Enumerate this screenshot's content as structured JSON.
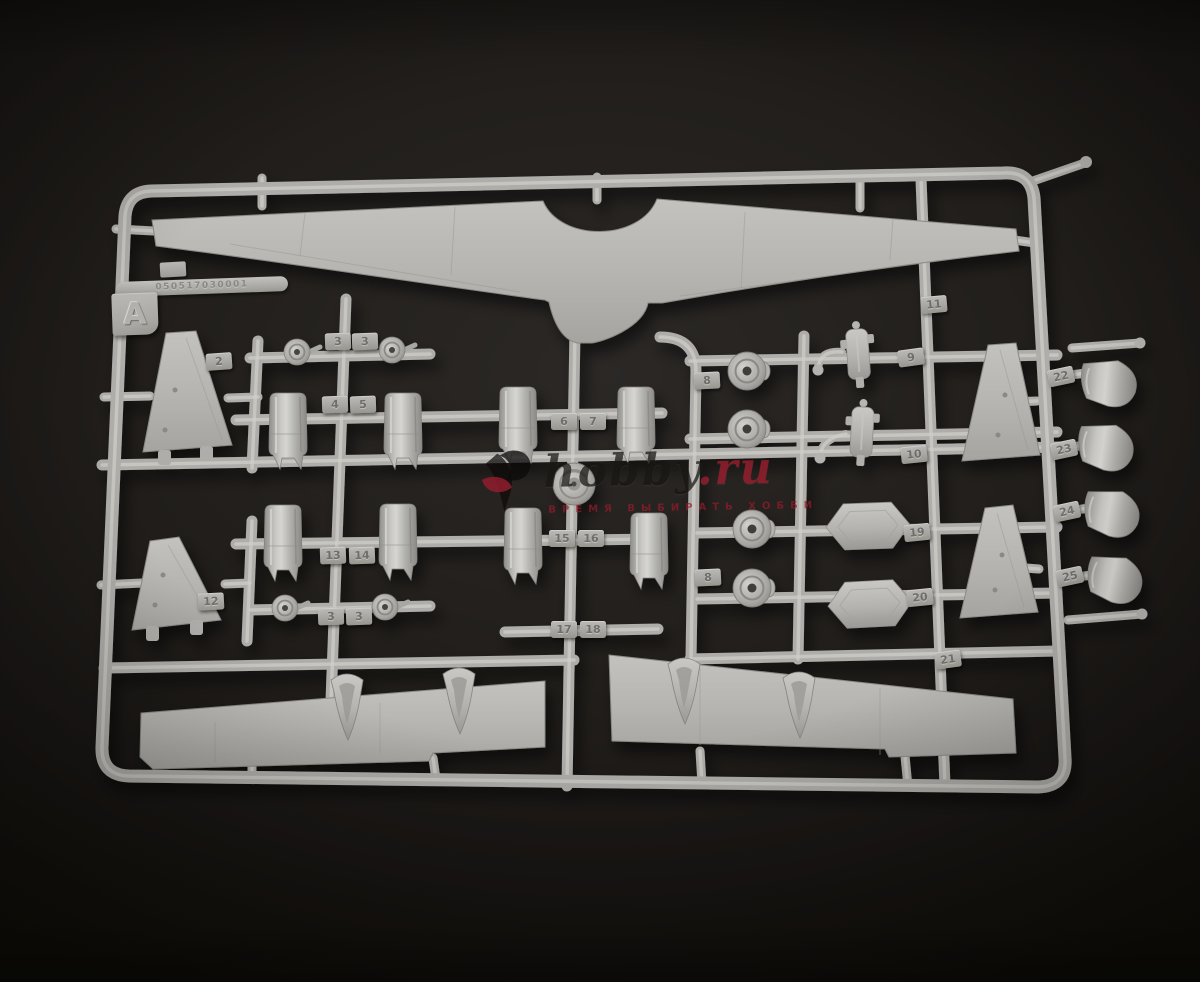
{
  "photo": {
    "subject": "Light-grey injection-molded plastic model kit sprue (frame A) with aircraft wing, tail, engine nacelle, wheel and radome parts, photographed on a dark backdrop",
    "plastic_color": "#b3b2ae",
    "background_color": "#211e1b"
  },
  "sprue": {
    "frame_letter": "A",
    "mold_number": "050517030001",
    "part_tags": [
      {
        "label": "2",
        "x": 206,
        "y": 353,
        "rot": -4
      },
      {
        "label": "3",
        "x": 325,
        "y": 333,
        "rot": -2
      },
      {
        "label": "3",
        "x": 352,
        "y": 333,
        "rot": -2
      },
      {
        "label": "4",
        "x": 322,
        "y": 396,
        "rot": -2
      },
      {
        "label": "5",
        "x": 350,
        "y": 396,
        "rot": -2
      },
      {
        "label": "6",
        "x": 551,
        "y": 413,
        "rot": 0
      },
      {
        "label": "7",
        "x": 580,
        "y": 413,
        "rot": 0
      },
      {
        "label": "8",
        "x": 694,
        "y": 372,
        "rot": -3
      },
      {
        "label": "8",
        "x": 695,
        "y": 569,
        "rot": -3
      },
      {
        "label": "9",
        "x": 898,
        "y": 349,
        "rot": -8
      },
      {
        "label": "10",
        "x": 901,
        "y": 446,
        "rot": -6
      },
      {
        "label": "11",
        "x": 921,
        "y": 296,
        "rot": -5
      },
      {
        "label": "12",
        "x": 198,
        "y": 593,
        "rot": -3
      },
      {
        "label": "13",
        "x": 320,
        "y": 547,
        "rot": -2
      },
      {
        "label": "14",
        "x": 349,
        "y": 547,
        "rot": -2
      },
      {
        "label": "15",
        "x": 549,
        "y": 530,
        "rot": 0
      },
      {
        "label": "16",
        "x": 578,
        "y": 530,
        "rot": 0
      },
      {
        "label": "17",
        "x": 551,
        "y": 621,
        "rot": 0
      },
      {
        "label": "18",
        "x": 580,
        "y": 621,
        "rot": 0
      },
      {
        "label": "19",
        "x": 904,
        "y": 524,
        "rot": -6
      },
      {
        "label": "20",
        "x": 907,
        "y": 589,
        "rot": -6
      },
      {
        "label": "21",
        "x": 935,
        "y": 651,
        "rot": -8
      },
      {
        "label": "22",
        "x": 1048,
        "y": 368,
        "rot": -12
      },
      {
        "label": "23",
        "x": 1051,
        "y": 441,
        "rot": -12
      },
      {
        "label": "24",
        "x": 1054,
        "y": 503,
        "rot": -12
      },
      {
        "label": "25",
        "x": 1057,
        "y": 568,
        "rot": -12
      },
      {
        "label": "3",
        "x": 318,
        "y": 608,
        "rot": -2
      },
      {
        "label": "3",
        "x": 346,
        "y": 608,
        "rot": -2
      }
    ]
  },
  "watermark": {
    "site": "hobby",
    "domain": ".ru",
    "tagline": "ВРЕМЯ ВЫБИРАТЬ ХОББИ",
    "accent_color": "#a01c2e"
  }
}
